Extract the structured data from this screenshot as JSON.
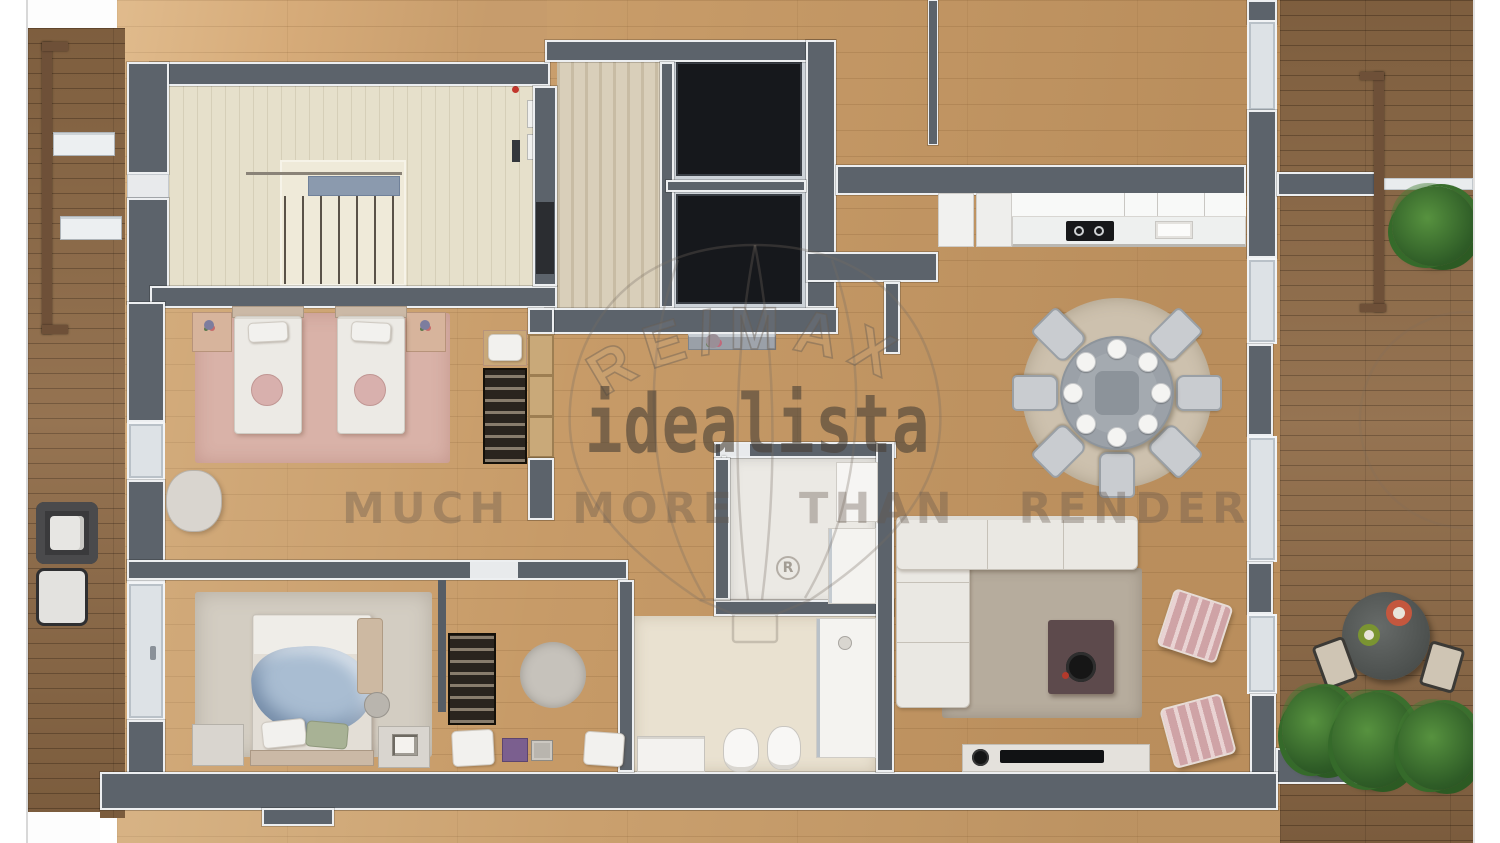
{
  "watermarks": {
    "brand_arc": "RE/MAX",
    "logo": "idealista",
    "tagline": "MUCH MORE THAN RENDER",
    "registered_mark": "R"
  },
  "theme": {
    "wall": "#5c636b",
    "trim": "#edeff1",
    "wood": "#c79b68",
    "terrace": "#8f6b47",
    "stair-floor": "#e6e0cb",
    "carpet": "#d9cfba",
    "bath-floor": "#e9e1d0",
    "rug-pink": "#d9b2a8",
    "rug-master": "#d3cdc2",
    "rug-dining": "#cdc1ae",
    "rug-living": "#b6ac9d",
    "pink": "#cfa3a6",
    "blanket-blue": "#a9bdd2",
    "elevator": "#16181c",
    "plant-green": "#3a6f2e",
    "watermark-ink": "#635749"
  }
}
